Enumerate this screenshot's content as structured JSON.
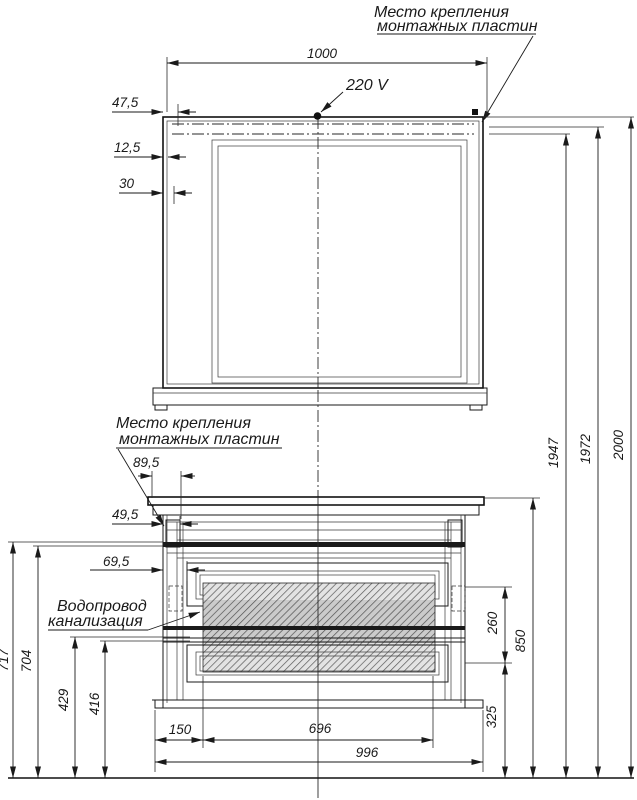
{
  "drawing": {
    "annotations": {
      "mounting_plates_top": {
        "line1": "Место крепления",
        "line2": "монтажных пластин"
      },
      "mounting_plates_cabinet": {
        "line1": "Место крепления",
        "line2": "монтажных пластин"
      },
      "power_supply": "220 V",
      "plumbing": {
        "line1": "Водопровод",
        "line2": "канализация"
      }
    },
    "dimensions_mm": {
      "mirror_plates_span": "1000",
      "mirror_edge_offset": "47,5",
      "mirror_frame_offset": "12,5",
      "mirror_frame_width": "30",
      "cabinet_plate_offset": "89,5",
      "cabinet_plate_width": "49,5",
      "cabinet_side_offset": "69,5",
      "pipe_height_1": "717",
      "pipe_height_2": "704",
      "pipe_height_3": "429",
      "pipe_height_4": "416",
      "base_left_offset": "150",
      "opening_width": "696",
      "cabinet_width": "996",
      "bottom_zone_height": "325",
      "pipe_zone_height": "260",
      "cabinet_height": "850",
      "height_to_plate_bottom": "1947",
      "height_to_plate_top": "1972",
      "total_height": "2000"
    },
    "colors": {
      "line": "#1a1a1a",
      "background": "#ffffff",
      "hatch_fill": "#e3e3e3"
    }
  }
}
